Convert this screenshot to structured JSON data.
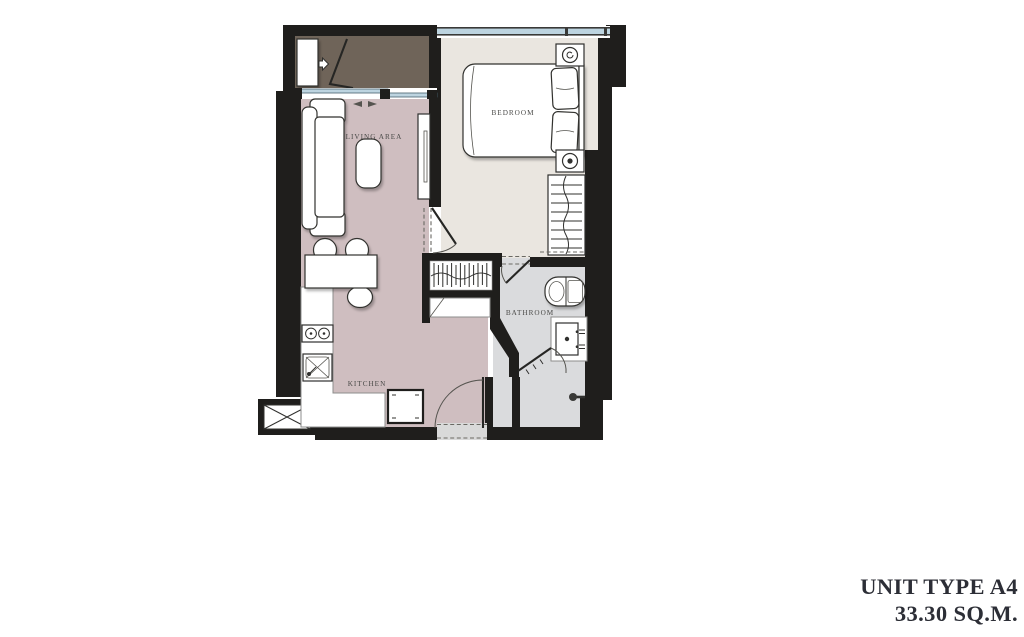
{
  "unit": {
    "title": "UNIT TYPE A4",
    "area": "33.30 SQ.M."
  },
  "rooms": {
    "bedroom": {
      "label": "BEDROOM"
    },
    "living": {
      "label": "LIVING AREA"
    },
    "kitchen": {
      "label": "KITCHEN"
    },
    "bathroom": {
      "label": "BATHROOM"
    }
  },
  "colors": {
    "wall": "#1f1e1c",
    "balcony_floor": "#6f6459",
    "living_floor": "#cfbec0",
    "bedroom_floor": "#eae6e0",
    "bathroom_floor": "#dadbdd",
    "window_glass": "#bdd4e0",
    "threshold": "#d9d9d9",
    "label_text": "#4a4a48",
    "title_text": "#2c2e36"
  },
  "icons": {
    "bed": "double-bed-top-view",
    "pillows": "two-pillows",
    "nightstand_lamp": "circle-swirl-lamp",
    "wardrobe": "hanging-rail-with-clothes",
    "sofa": "sofa-top-view",
    "coffee_table": "rounded-table",
    "tv_console": "media-console",
    "dining_table": "table-with-stools",
    "cooktop": "two-burner-hob",
    "kitchen_sink": "sink-with-cross",
    "fridge": "appliance-square",
    "toilet": "toilet-top-view",
    "vanity_basin": "basin-with-taps",
    "shower_head": "shower-head",
    "shaft": "crossed-box-shaft",
    "door_swing": "quarter-arc-door",
    "sliding_door": "double-track-slider",
    "ac_unit": "condenser-unit-with-arrow"
  }
}
